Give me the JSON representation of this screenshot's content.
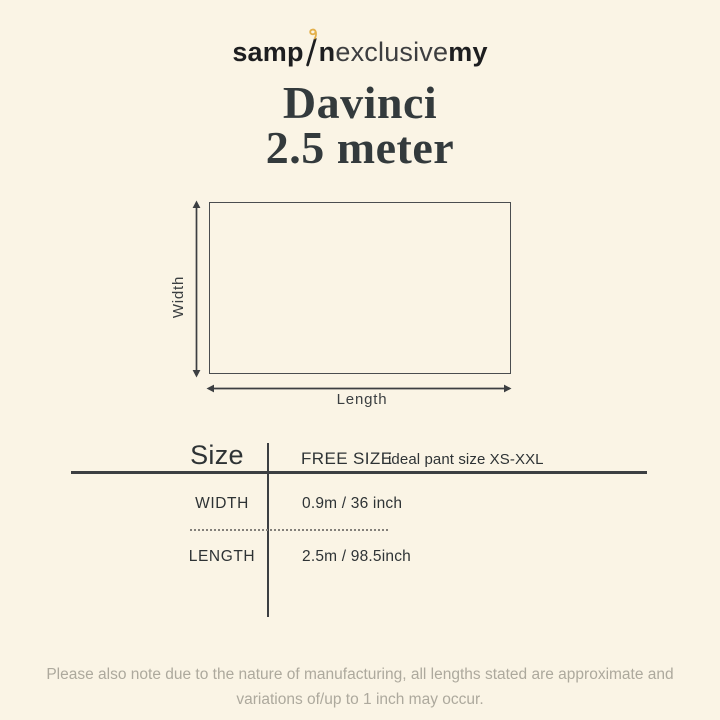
{
  "brand": {
    "logo_bold_1": "samp",
    "logo_bold_2": "n",
    "logo_light": "exclusive",
    "logo_bold_3": "my"
  },
  "title": {
    "line1": "Davinci",
    "line2": "2.5 meter"
  },
  "diagram": {
    "width_label": "Width",
    "length_label": "Length"
  },
  "size_table": {
    "header_label": "Size",
    "size_value": "FREE SIZE",
    "size_note": "ideal pant size XS-XXL",
    "rows": [
      {
        "label": "WIDTH",
        "value": "0.9m / 36 inch"
      },
      {
        "label": "LENGTH",
        "value": "2.5m / 98.5inch"
      }
    ]
  },
  "footer": {
    "line1": "Please also note due to the nature of manufacturing, all lengths stated are approximate and",
    "line2": "variations of/up to 1 inch may occur."
  },
  "colors": {
    "background": "#faf4e5",
    "text_dark": "#2e3335",
    "line": "#3c3f42",
    "footer_text": "#ada99d",
    "accent_gold": "#e3b04b"
  }
}
